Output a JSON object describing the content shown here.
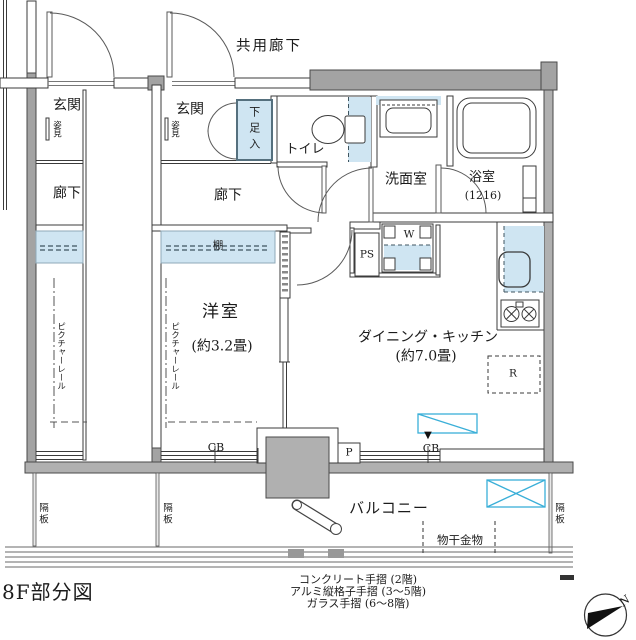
{
  "title": "8F部分図",
  "common_corridor": "共用廊下",
  "adjacent_unit": {
    "entrance": "玄関",
    "mirror": "姿見",
    "hallway": "廊下",
    "picture_rail": "ピクチャーレール",
    "balcony_partition": "隔板"
  },
  "unit": {
    "entrance": "玄関",
    "mirror": "姿見",
    "shoe_cabinet": "下足入",
    "toilet": "トイレ",
    "washroom": "洗面室",
    "bathroom": "浴室",
    "bathroom_size": "(1216)",
    "hallway": "廊下",
    "shelf": "棚",
    "picture_rail": "ピクチャーレール",
    "western_room": "洋室",
    "western_room_size": "(約3.2畳)",
    "dining_kitchen": "ダイニング・キッチン",
    "dining_kitchen_size": "(約7.0畳)",
    "pipe_space": "PS",
    "washer": "W",
    "refrigerator": "R",
    "pillar": "P",
    "window_left": "CB",
    "window_right": "CB",
    "window_marker": "▼"
  },
  "balcony": {
    "label": "バルコニー",
    "laundry_hardware": "物干金物",
    "partition_left": "隔板",
    "partition_center": "隔板",
    "partition_right": "隔板"
  },
  "legend": [
    "コンクリート手摺 (2階)",
    "アルミ縦格子手摺 (3〜5階)",
    "ガラス手摺 (6〜8階)"
  ],
  "compass_north": "N",
  "colors": {
    "fixture_blue": "#cfe5f2",
    "outline_cyan": "#3aafd8",
    "wall_gray": "#a3a3a3"
  }
}
